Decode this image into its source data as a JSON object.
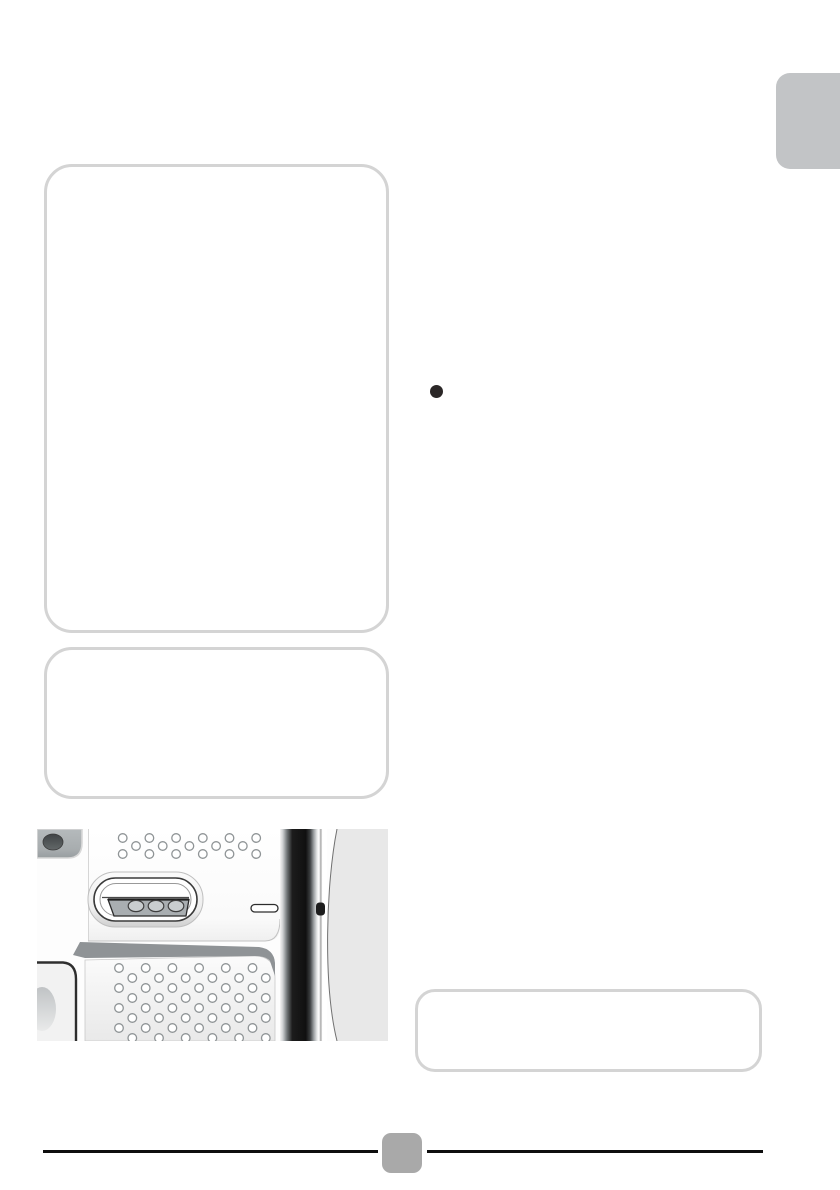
{
  "page": {
    "background": "#ffffff",
    "description": "manual page with empty callout boxes and device photo"
  },
  "side_tab": {
    "color": "#c2c4c6"
  },
  "callout_boxes": {
    "border_color": "#d4d4d4",
    "items": [
      {
        "id": "box-top-left",
        "text": ""
      },
      {
        "id": "box-mid-left",
        "text": ""
      },
      {
        "id": "box-bottom-right",
        "text": ""
      }
    ]
  },
  "bullet": {
    "glyph": "●",
    "color": "#2b2727"
  },
  "photo": {
    "alt": "Grayscale close-up of device back panel: speaker hole grids, contact slot with three charging contacts, small indicator slot, dark side rail",
    "elements": [
      "camera-lens-corner",
      "speaker-holes-top",
      "contact-slot",
      "charging-contacts",
      "indicator-slot",
      "divider-band",
      "speaker-holes-bottom",
      "side-rail",
      "latch-notch"
    ],
    "colors": {
      "panel": "#fbfbfb",
      "band": "#8f9396",
      "rail_dark": "#111111",
      "background_right": "#e8e8e8"
    }
  },
  "footer": {
    "rule_color": "#0e0e0e",
    "page_marker_color": "#a9a9a9"
  }
}
